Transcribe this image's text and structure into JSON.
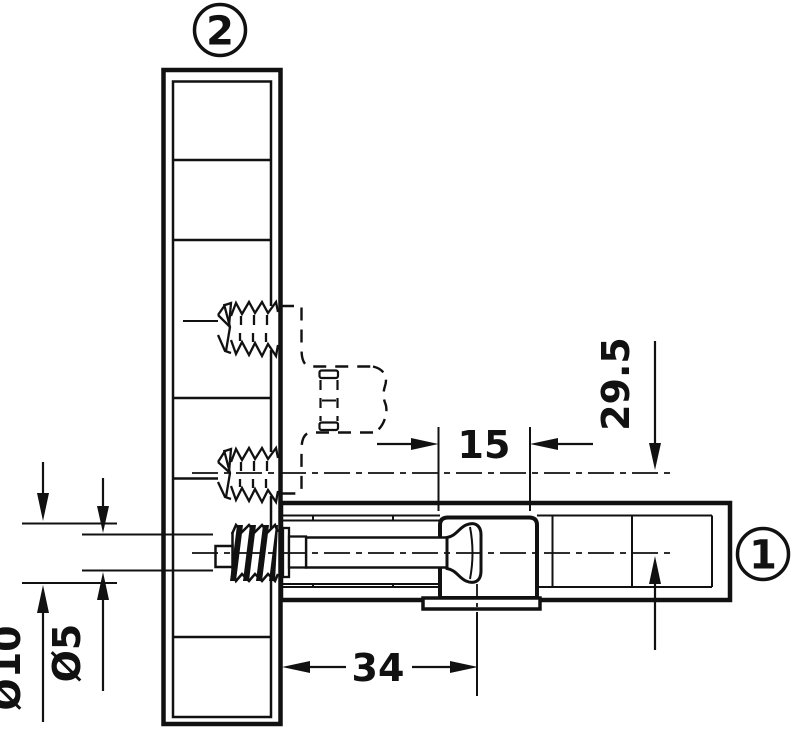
{
  "drawing": {
    "labels": {
      "part1": "1",
      "part2": "2"
    },
    "dimensions": {
      "housing_hole": "15",
      "drill_distance": "29.5",
      "bolt_axis": "34",
      "thread_outer": "Ø10",
      "thread_core": "Ø5"
    }
  }
}
